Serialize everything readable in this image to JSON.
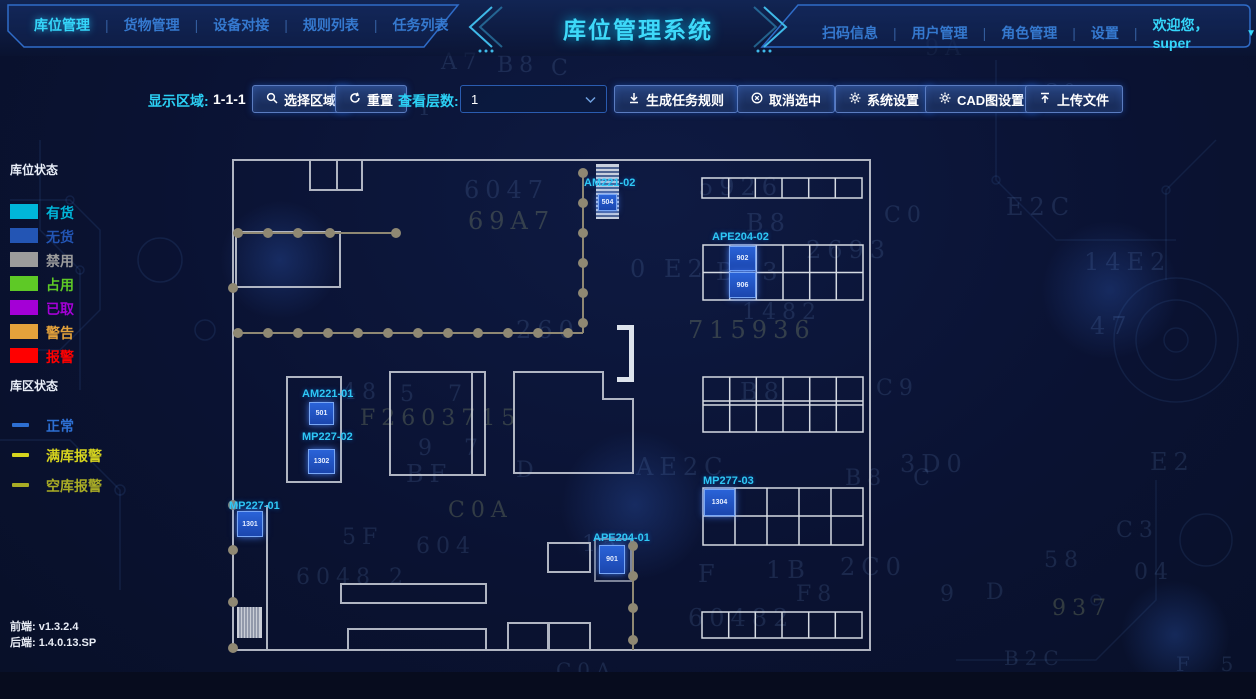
{
  "header": {
    "title": "库位管理系统",
    "nav_left": [
      {
        "label": "库位管理"
      },
      {
        "label": "货物管理"
      },
      {
        "label": "设备对接"
      },
      {
        "label": "规则列表"
      },
      {
        "label": "任务列表"
      }
    ],
    "nav_right": [
      {
        "label": "扫码信息"
      },
      {
        "label": "用户管理"
      },
      {
        "label": "角色管理"
      },
      {
        "label": "设置"
      }
    ],
    "welcome": "欢迎您，super"
  },
  "toolbar": {
    "display_area_label": "显示区域:",
    "display_area_value": "1-1-1",
    "select_area_btn": "选择区域",
    "reset_btn": "重置",
    "view_layer_label": "查看层数:",
    "layer_value": "1",
    "gen_rule_btn": "生成任务规则",
    "cancel_btn": "取消选中",
    "sys_btn": "系统设置",
    "cad_btn": "CAD图设置",
    "upload_btn": "上传文件"
  },
  "legend": {
    "slot_title": "库位状态",
    "slot_items": [
      {
        "label": "有货",
        "color": "#00b6d9"
      },
      {
        "label": "无货",
        "color": "#2355b4"
      },
      {
        "label": "禁用",
        "color": "#9c9c9c"
      },
      {
        "label": "占用",
        "color": "#5ec926"
      },
      {
        "label": "已取",
        "color": "#a400d6"
      },
      {
        "label": "警告",
        "color": "#e4a23b"
      },
      {
        "label": "报警",
        "color": "#ff0000"
      }
    ],
    "area_title": "库区状态",
    "area_items": [
      {
        "label": "正常",
        "color": "#2d6fd2"
      },
      {
        "label": "满库报警",
        "color": "#d6d41e"
      },
      {
        "label": "空库报警",
        "color": "#a9ac25"
      }
    ]
  },
  "footer": {
    "frontend": "前端: v1.3.2.4",
    "backend": "后端: 1.4.0.13.SP"
  },
  "floorplan": {
    "units": [
      {
        "id": "AM221-02",
        "cells": [
          "504"
        ]
      },
      {
        "id": "APE204-02",
        "cells": [
          "902",
          "906"
        ]
      },
      {
        "id": "AM221-01",
        "cells": [
          "501"
        ]
      },
      {
        "id": "MP227-02",
        "cells": [
          "1302"
        ]
      },
      {
        "id": "MP227-01",
        "cells": [
          "1301"
        ]
      },
      {
        "id": "MP277-03",
        "cells": [
          "1304"
        ]
      },
      {
        "id": "APE204-01",
        "cells": [
          "901"
        ]
      }
    ]
  },
  "background_glyphs": [
    {
      "t": "A7",
      "x": 441,
      "y": 50,
      "s": 22,
      "c": "dim"
    },
    {
      "t": "B8",
      "x": 497,
      "y": 53,
      "s": 22,
      "c": "dim"
    },
    {
      "t": "C",
      "x": 551,
      "y": 56,
      "s": 22,
      "c": "dim"
    },
    {
      "t": "9A",
      "x": 925,
      "y": 36,
      "s": 22,
      "c": "dim"
    },
    {
      "t": "1",
      "x": 418,
      "y": 96,
      "s": 20,
      "c": "dim"
    },
    {
      "t": "E",
      "x": 986,
      "y": 82,
      "s": 18,
      "c": "dim"
    },
    {
      "t": "C0",
      "x": 1044,
      "y": 80,
      "s": 18,
      "c": "dim"
    },
    {
      "t": "6047",
      "x": 464,
      "y": 176,
      "s": 24,
      "c": "dim"
    },
    {
      "t": "5926",
      "x": 698,
      "y": 173,
      "s": 24,
      "c": "dim"
    },
    {
      "t": "69A7",
      "x": 468,
      "y": 207,
      "s": 24,
      "c": "olv"
    },
    {
      "t": "B8",
      "x": 746,
      "y": 209,
      "s": 24,
      "c": "dim"
    },
    {
      "t": "C0",
      "x": 884,
      "y": 203,
      "s": 22,
      "c": "dim"
    },
    {
      "t": "E2C",
      "x": 1006,
      "y": 193,
      "s": 24,
      "c": "dim"
    },
    {
      "t": "2693",
      "x": 806,
      "y": 236,
      "s": 24,
      "c": "dim"
    },
    {
      "t": "0",
      "x": 630,
      "y": 255,
      "s": 24,
      "c": "dim"
    },
    {
      "t": "E2",
      "x": 664,
      "y": 255,
      "s": 24,
      "c": "dim"
    },
    {
      "t": "BF3",
      "x": 716,
      "y": 258,
      "s": 24,
      "c": "dim"
    },
    {
      "t": "14E2",
      "x": 1084,
      "y": 248,
      "s": 24,
      "c": "dim"
    },
    {
      "t": "1482",
      "x": 742,
      "y": 300,
      "s": 22,
      "c": "dim"
    },
    {
      "t": "260",
      "x": 516,
      "y": 316,
      "s": 24,
      "c": "dim"
    },
    {
      "t": "715936",
      "x": 688,
      "y": 316,
      "s": 24,
      "c": "olv"
    },
    {
      "t": "47",
      "x": 1090,
      "y": 312,
      "s": 24,
      "c": "dim"
    },
    {
      "t": "48",
      "x": 342,
      "y": 380,
      "s": 22,
      "c": "dim"
    },
    {
      "t": "5",
      "x": 400,
      "y": 382,
      "s": 22,
      "c": "dim"
    },
    {
      "t": "7",
      "x": 448,
      "y": 382,
      "s": 22,
      "c": "dim"
    },
    {
      "t": "B8",
      "x": 740,
      "y": 378,
      "s": 24,
      "c": "dim"
    },
    {
      "t": "C9",
      "x": 876,
      "y": 376,
      "s": 22,
      "c": "dim"
    },
    {
      "t": "F2603715",
      "x": 360,
      "y": 406,
      "s": 22,
      "c": "olv"
    },
    {
      "t": "9  7",
      "x": 418,
      "y": 436,
      "s": 22,
      "c": "dim"
    },
    {
      "t": "BF",
      "x": 406,
      "y": 460,
      "s": 24,
      "c": "dim"
    },
    {
      "t": "D",
      "x": 516,
      "y": 458,
      "s": 22,
      "c": "dim"
    },
    {
      "t": "AE2C",
      "x": 636,
      "y": 453,
      "s": 24,
      "c": "dim"
    },
    {
      "t": "3D0",
      "x": 900,
      "y": 450,
      "s": 24,
      "c": "dim"
    },
    {
      "t": "E2",
      "x": 1150,
      "y": 448,
      "s": 24,
      "c": "dim"
    },
    {
      "t": "B8  C",
      "x": 845,
      "y": 466,
      "s": 22,
      "c": "dim"
    },
    {
      "t": "C0A",
      "x": 448,
      "y": 498,
      "s": 22,
      "c": "olv"
    },
    {
      "t": "5F",
      "x": 342,
      "y": 525,
      "s": 22,
      "c": "dim"
    },
    {
      "t": "604",
      "x": 416,
      "y": 534,
      "s": 22,
      "c": "dim"
    },
    {
      "t": "15",
      "x": 582,
      "y": 532,
      "s": 22,
      "c": "dim"
    },
    {
      "t": "58",
      "x": 1044,
      "y": 548,
      "s": 22,
      "c": "dim"
    },
    {
      "t": "C3",
      "x": 1116,
      "y": 518,
      "s": 22,
      "c": "dim"
    },
    {
      "t": "F",
      "x": 698,
      "y": 560,
      "s": 24,
      "c": "dim"
    },
    {
      "t": "1B",
      "x": 766,
      "y": 556,
      "s": 24,
      "c": "dim"
    },
    {
      "t": "2C0",
      "x": 840,
      "y": 553,
      "s": 24,
      "c": "dim"
    },
    {
      "t": "6048 2",
      "x": 296,
      "y": 565,
      "s": 22,
      "c": "dim"
    },
    {
      "t": "F8",
      "x": 796,
      "y": 582,
      "s": 22,
      "c": "dim"
    },
    {
      "t": "9",
      "x": 940,
      "y": 582,
      "s": 22,
      "c": "dim"
    },
    {
      "t": "D",
      "x": 986,
      "y": 580,
      "s": 22,
      "c": "dim"
    },
    {
      "t": "60482",
      "x": 688,
      "y": 604,
      "s": 24,
      "c": "dim"
    },
    {
      "t": "937",
      "x": 1052,
      "y": 596,
      "s": 22,
      "c": "olv"
    },
    {
      "t": "04",
      "x": 1134,
      "y": 560,
      "s": 22,
      "c": "dim"
    },
    {
      "t": "C0A",
      "x": 556,
      "y": 658,
      "s": 20,
      "c": "dim"
    },
    {
      "t": "B2C",
      "x": 1004,
      "y": 646,
      "s": 20,
      "c": "dim"
    },
    {
      "t": "F  5",
      "x": 1176,
      "y": 652,
      "s": 20,
      "c": "dim"
    }
  ]
}
